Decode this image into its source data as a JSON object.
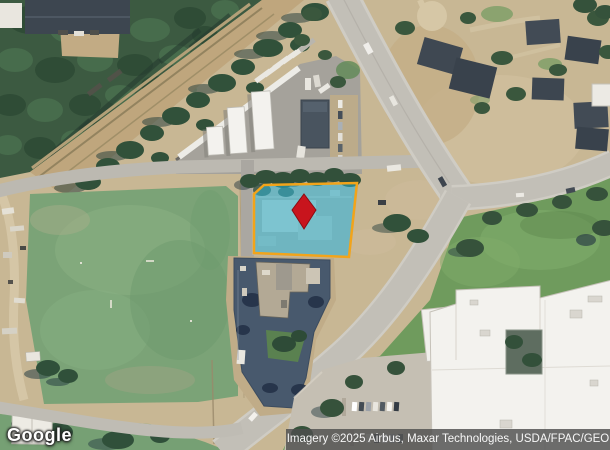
{
  "map": {
    "logo_text": "Google",
    "attribution": "Imagery ©2025 Airbus, Maxar Technologies, USDA/FPAC/GEO",
    "parcel_highlight": {
      "fill": "rgba(38,186,221,0.5)",
      "stroke": "#f2a41a",
      "stroke_width": "2.5"
    },
    "pin": {
      "icon": "location-pin-icon",
      "fill": "#c8141d",
      "stroke": "#8a0d13"
    }
  }
}
